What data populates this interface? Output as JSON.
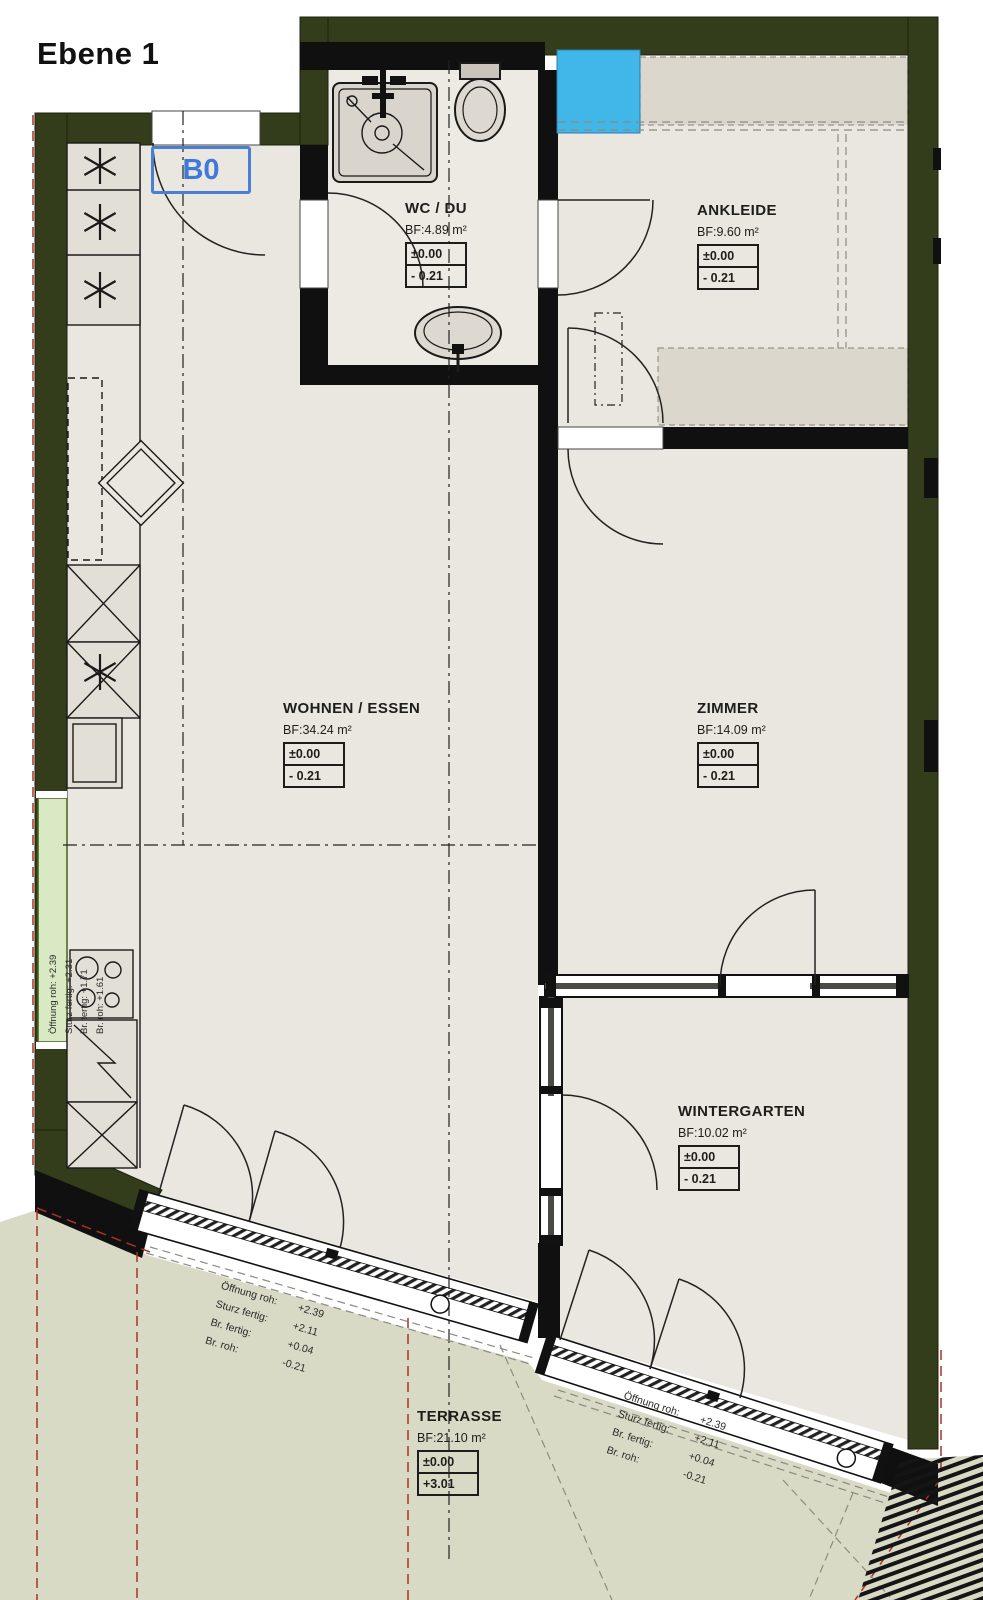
{
  "title": "Ebene 1",
  "door_tag": "B0",
  "rooms": [
    {
      "id": "wc",
      "name": "WC / DU",
      "area": "BF:4.89 m²",
      "level_top": "±0.00",
      "level_bottom": "- 0.21"
    },
    {
      "id": "ankleide",
      "name": "ANKLEIDE",
      "area": "BF:9.60 m²",
      "level_top": "±0.00",
      "level_bottom": "- 0.21"
    },
    {
      "id": "wohnen",
      "name": "WOHNEN / ESSEN",
      "area": "BF:34.24 m²",
      "level_top": "±0.00",
      "level_bottom": "- 0.21"
    },
    {
      "id": "zimmer",
      "name": "ZIMMER",
      "area": "BF:14.09 m²",
      "level_top": "±0.00",
      "level_bottom": "- 0.21"
    },
    {
      "id": "wintergarten",
      "name": "WINTERGARTEN",
      "area": "BF:10.02 m²",
      "level_top": "±0.00",
      "level_bottom": "- 0.21"
    },
    {
      "id": "terrasse",
      "name": "TERRASSE",
      "area": "BF:21.10 m²",
      "level_top": "±0.00",
      "level_bottom": "+3.01"
    }
  ],
  "annotations": {
    "kitchen_window": {
      "line1": "Öffnung roh:  +2.39",
      "line2": "Sturz fertig:  +2.31",
      "line3": "Br. fertig:  +1.71",
      "line4": "Br. roh:  +1.61"
    },
    "terrace_door_left": {
      "rows": [
        {
          "label": "Öffnung roh:",
          "value": "+2.39"
        },
        {
          "label": "Sturz fertig:",
          "value": "+2.11"
        },
        {
          "label": "Br. fertig:",
          "value": "+0.04"
        },
        {
          "label": "Br. roh:",
          "value": "-0.21"
        }
      ]
    },
    "terrace_door_right": {
      "rows": [
        {
          "label": "Öffnung roh:",
          "value": "+2.39"
        },
        {
          "label": "Sturz fertig:",
          "value": "+2.11"
        },
        {
          "label": "Br. fertig:",
          "value": "+0.04"
        },
        {
          "label": "Br. roh:",
          "value": "-0.21"
        }
      ]
    }
  },
  "colors": {
    "outer_wall": "#333d1b",
    "interior_wall": "#101010",
    "floor": "#e9e7df",
    "wc_floor": "#eceae3",
    "wardrobe": "#dbd7cd",
    "terrace": "#d9dac6",
    "skylight_blue": "#41b6e9",
    "door_tag_blue": "#4a7fd6",
    "marker_red": "#a93226",
    "window_green": "#d9e9c3"
  }
}
